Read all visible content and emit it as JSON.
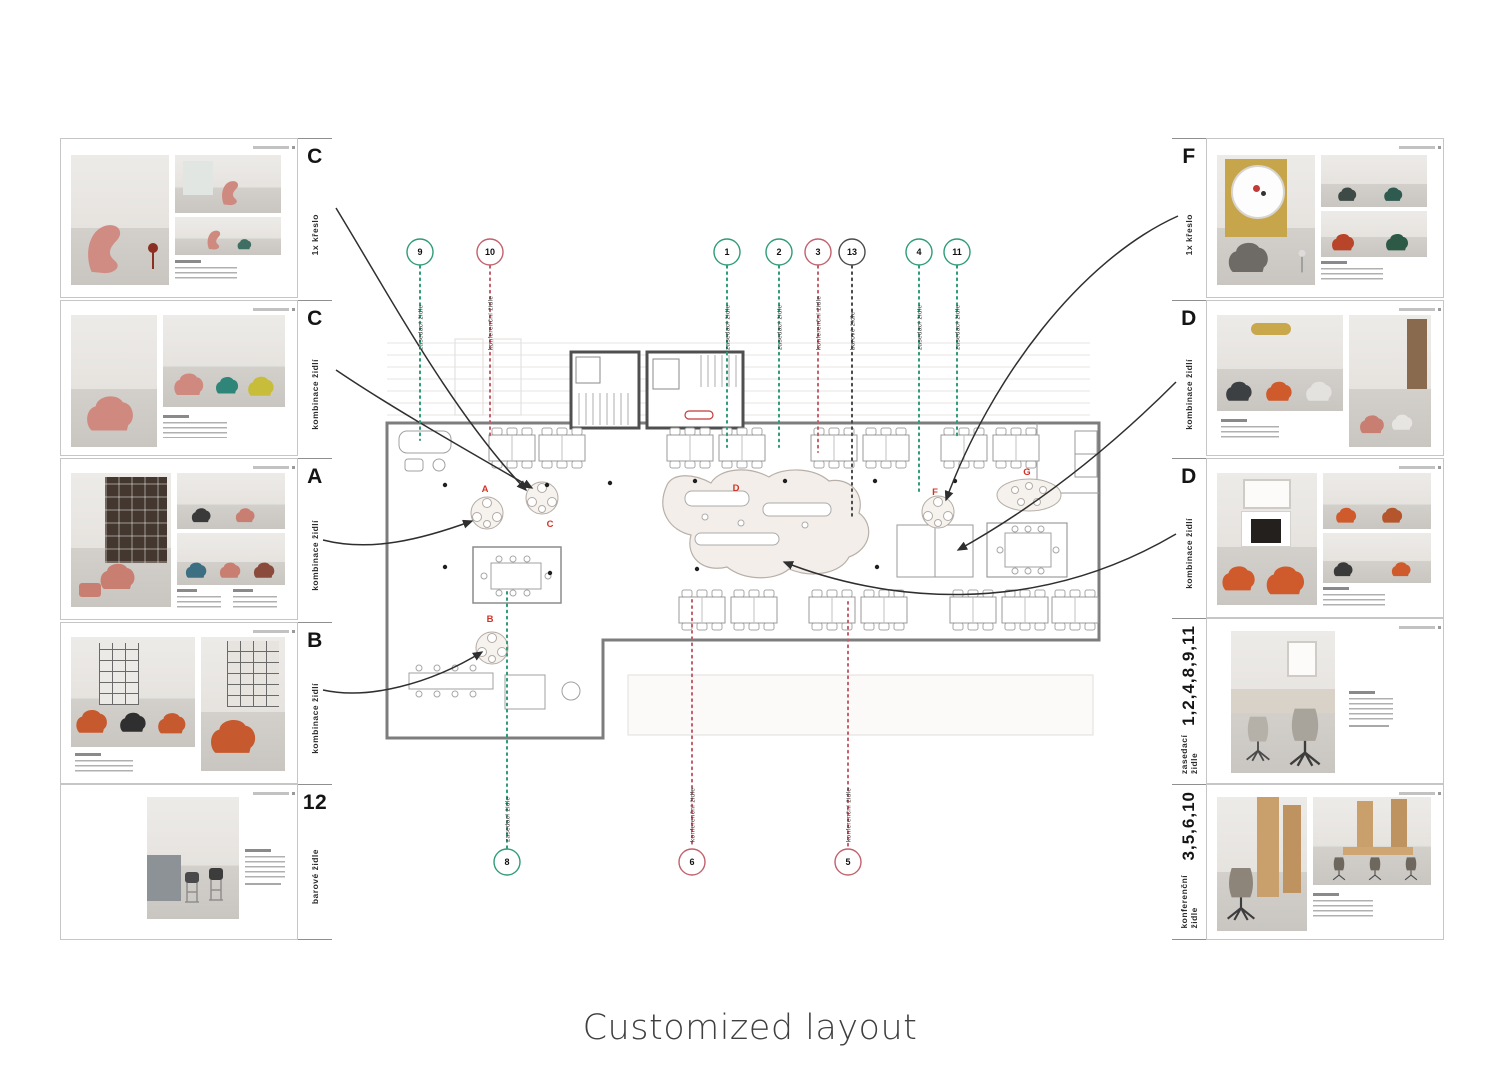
{
  "caption": "Customized layout",
  "colors": {
    "green": "#2e9c77",
    "pink": "#c2606c",
    "dark": "#4a4a4a",
    "red": "#d33227",
    "line": "#2f2f2f"
  },
  "cards": {
    "left": [
      {
        "label": "C",
        "category": "1x křeslo"
      },
      {
        "label": "C",
        "category": "kombinace židlí"
      },
      {
        "label": "A",
        "category": "kombinace židlí"
      },
      {
        "label": "B",
        "category": "kombinace židlí"
      },
      {
        "label": "12",
        "category": "barové židle"
      }
    ],
    "right": [
      {
        "label": "F",
        "category": "1x křeslo"
      },
      {
        "label": "D",
        "category": "kombinace židlí"
      },
      {
        "label": "D",
        "category": "kombinace židlí"
      },
      {
        "label": "1,2,4,8,9,11",
        "category": "zasedací židle"
      },
      {
        "label": "3,5,6,10",
        "category": "konferenční židle"
      }
    ]
  },
  "plan": {
    "area_labels": {
      "a": "A",
      "b": "B",
      "c": "C",
      "d": "D",
      "f": "F",
      "g": "G"
    },
    "top_markers": [
      {
        "num": "9",
        "color": "green",
        "label": "zasedací židle",
        "x": 420,
        "end": 440
      },
      {
        "num": "10",
        "color": "pink",
        "label": "konferenční židle",
        "x": 490,
        "end": 437
      },
      {
        "num": "1",
        "color": "green",
        "label": "zasedací židle",
        "x": 727,
        "end": 447
      },
      {
        "num": "2",
        "color": "green",
        "label": "zasedací židle",
        "x": 779,
        "end": 447
      },
      {
        "num": "3",
        "color": "pink",
        "label": "konferenční židle",
        "x": 818,
        "end": 452
      },
      {
        "num": "13",
        "color": "dark",
        "label": "barové židle",
        "x": 852,
        "end": 517
      },
      {
        "num": "4",
        "color": "green",
        "label": "zasedací židle",
        "x": 919,
        "end": 494
      },
      {
        "num": "11",
        "color": "green",
        "label": "zasedací židle",
        "x": 957,
        "end": 437
      }
    ],
    "bottom_markers": [
      {
        "num": "8",
        "color": "green",
        "label": "zasedací židle",
        "x": 507,
        "end": 592
      },
      {
        "num": "6",
        "color": "pink",
        "label": "konferenční židle",
        "x": 692,
        "end": 600
      },
      {
        "num": "5",
        "color": "pink",
        "label": "konferenční židle",
        "x": 848,
        "end": 602
      }
    ]
  }
}
